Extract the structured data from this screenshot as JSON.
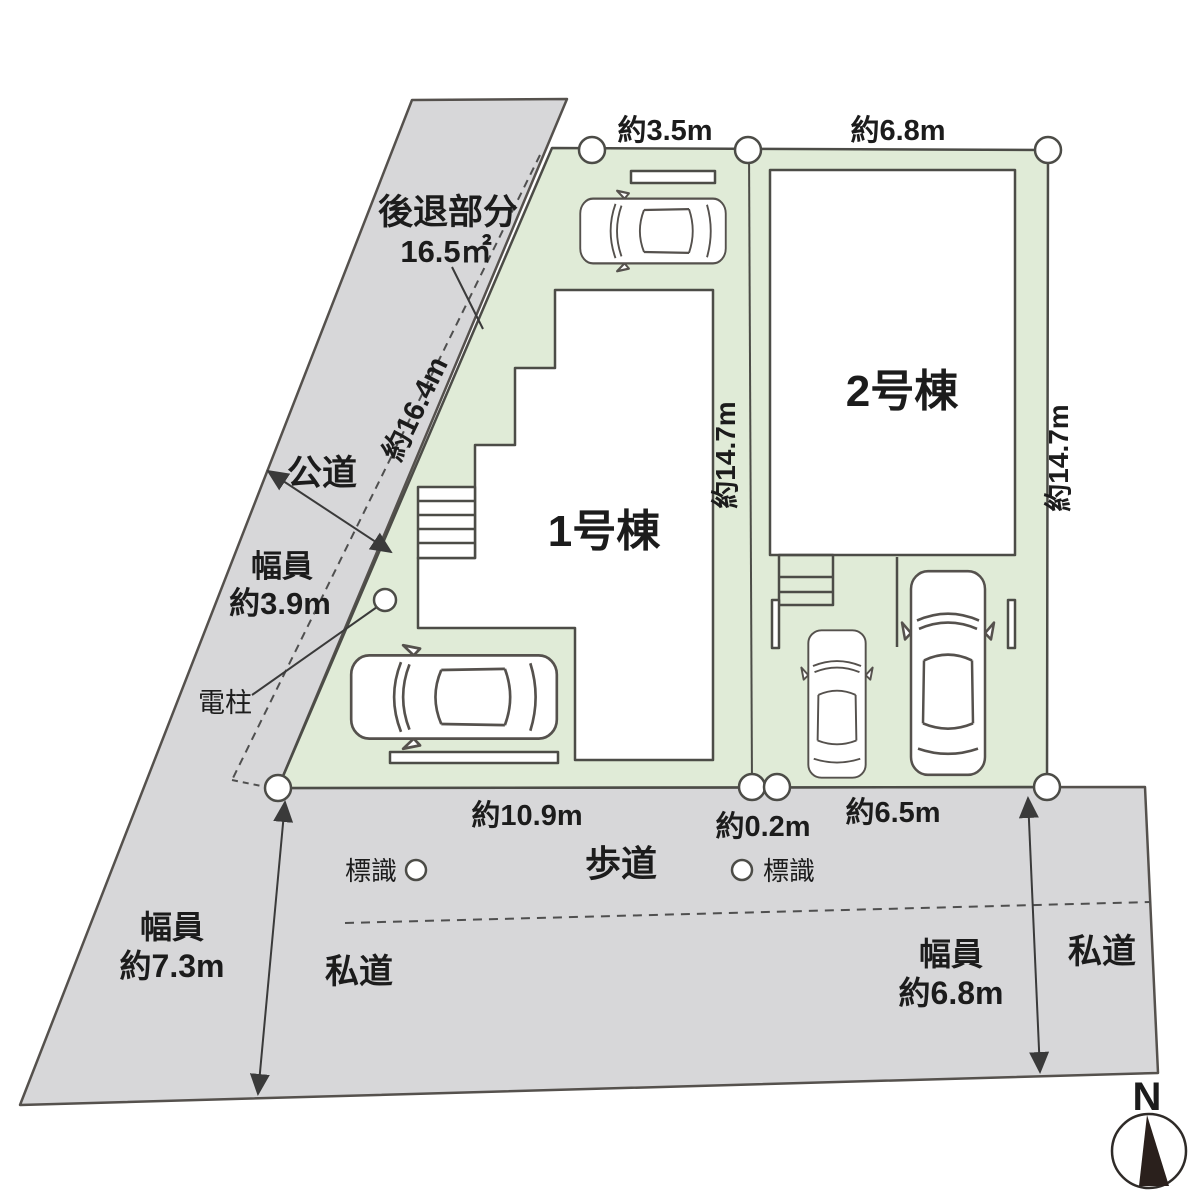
{
  "colors": {
    "road_gray": "#d7d7d9",
    "lot_green": "#e0ebd7",
    "outline": "#55514d",
    "text": "#1c1c1c",
    "compass_needle": "#2a201c"
  },
  "setback": {
    "label": "後退部分",
    "area": "16.5㎡"
  },
  "public_road": {
    "name": "公道",
    "width_caption": "幅員",
    "width_value": "約3.9m",
    "frontage_length": "約16.4m"
  },
  "utility_pole_label": "電柱",
  "buildings": [
    {
      "label": "1号棟"
    },
    {
      "label": "2号棟"
    }
  ],
  "dimensions": {
    "lot1_top": "約3.5m",
    "lot2_top": "約6.8m",
    "lot1_right": "約14.7m",
    "lot2_right": "約14.7m",
    "lot1_bottom": "約10.9m",
    "gap_bottom": "約0.2m",
    "lot2_bottom": "約6.5m"
  },
  "sidewalk_label": "歩道",
  "sign_left_label": "標識",
  "sign_right_label": "標識",
  "road_width_left": {
    "caption": "幅員",
    "value": "約7.3m"
  },
  "road_width_right": {
    "caption": "幅員",
    "value": "約6.8m"
  },
  "private_road_left": "私道",
  "private_road_right": "私道",
  "compass_label": "N"
}
